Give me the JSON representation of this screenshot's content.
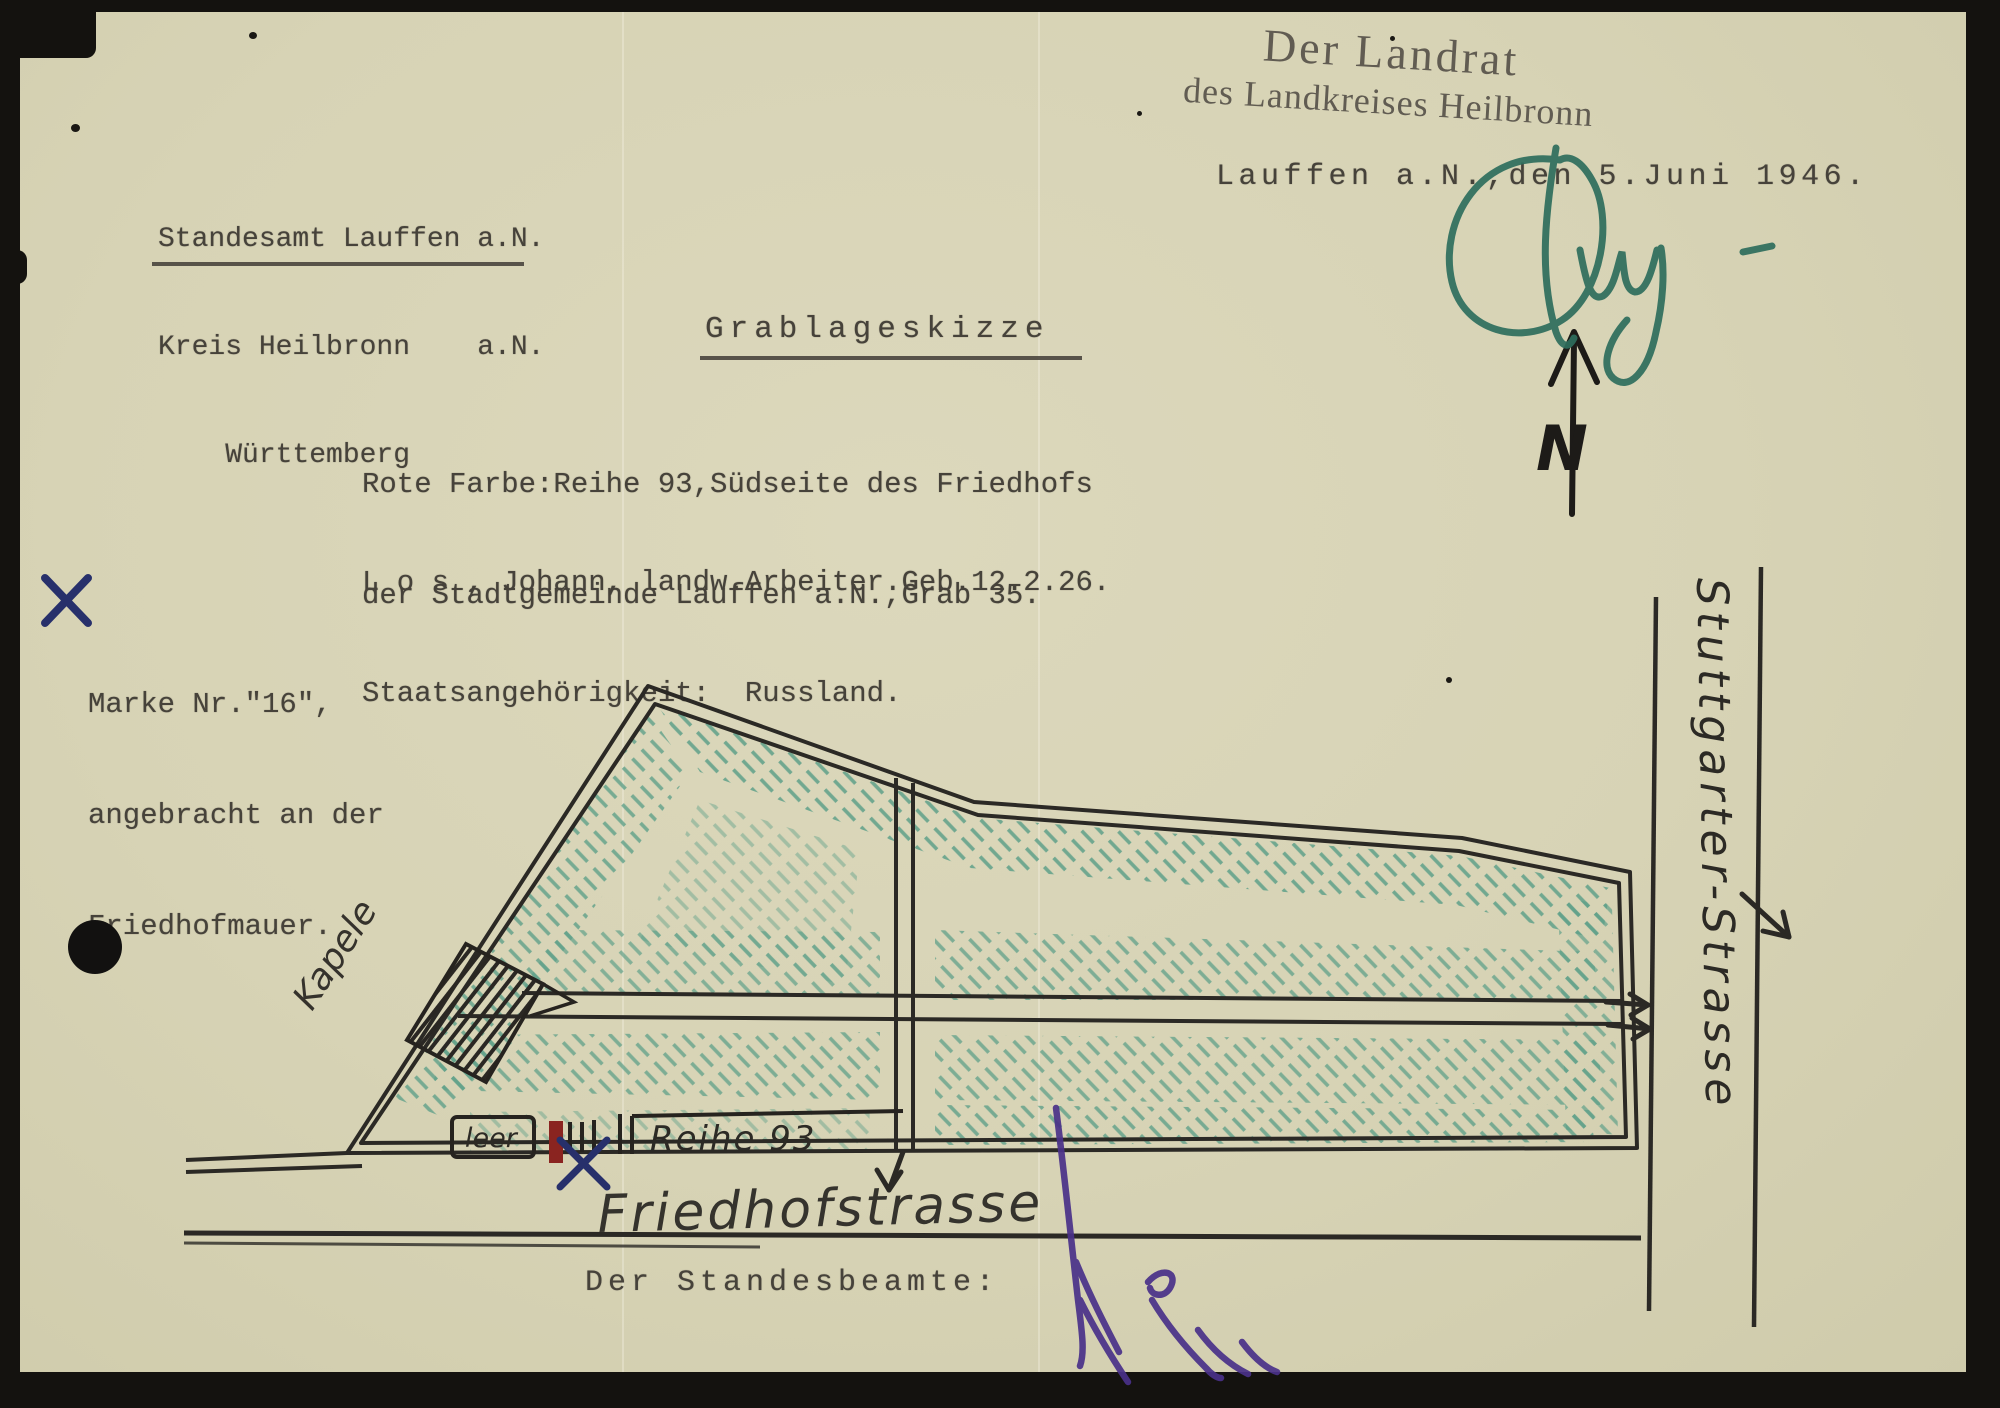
{
  "document": {
    "sender": {
      "line1": "Standesamt Lauffen a.N.",
      "line2": "Kreis Heilbronn    a.N.",
      "line3": "    Württemberg"
    },
    "stamp": {
      "line1": "Der Landrat",
      "line2": "des Landkreises Heilbronn"
    },
    "dateline": "Lauffen a.N.,den 5.Juni 1946.",
    "title": "Grablageskizze",
    "body": {
      "line1": "Rote Farbe:Reihe 93,Südseite des Friedhofs",
      "line2": "der Stadtgemeinde Lauffen a.N.,Grab 35.",
      "line3": "L o s , Johann, landw.Arbeiter.Geb.12.2.26.",
      "line4": "Staatsangehörigkeit:  Russland."
    },
    "margin_note": {
      "line1": "Marke Nr.\"16\",",
      "line2": "angebracht an der",
      "line3": "Friedhofmauer."
    },
    "officiant_label": "Der Standesbeamte:"
  },
  "sketch": {
    "north_label": "N",
    "chapel_label": "Kapele",
    "vacant_label": "leer",
    "row_label": "Reihe 93",
    "street_south": "Friedhofstrasse",
    "street_east": "Stuttgarter-Strasse"
  },
  "colors": {
    "paper": "#d7d3b5",
    "ink_typewriter": "#46423a",
    "ink_stamp": "#57524a",
    "pencil": "#2b2925",
    "hatch_green": "#5fa089",
    "signature_green": "#2e6e5d",
    "signature_purple": "#4a3189",
    "mark_red": "#8a2420",
    "mark_blue": "#27306b"
  }
}
